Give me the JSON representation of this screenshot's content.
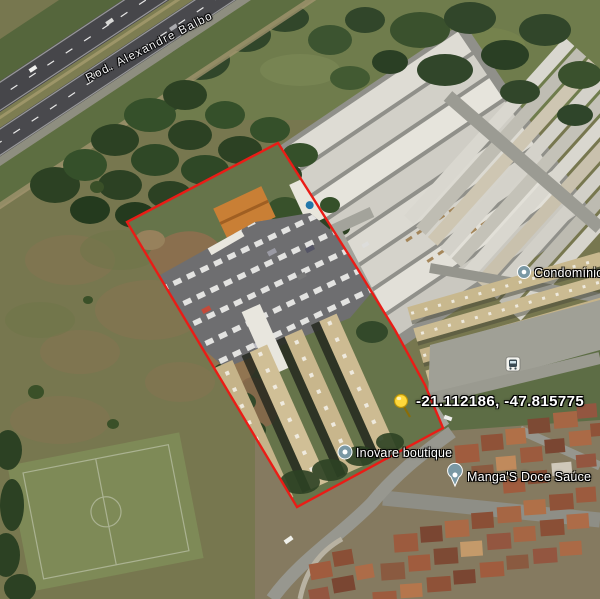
{
  "map": {
    "view": "satellite",
    "highway_label": "Rod. Alexandre Balbo",
    "pin": {
      "coordinates": "-21.112186, -47.815775",
      "icon": "yellow-pushpin",
      "color": "#ffd83b"
    },
    "boundary": {
      "shape": "polygon",
      "color": "#ea1c16"
    },
    "pois": [
      {
        "name": "Inovare boutique",
        "icon": "poi-circle"
      },
      {
        "name": "Manga'S Doce Saúce",
        "icon": "poi-circle"
      },
      {
        "name": "Condomínio Vi",
        "icon": "poi-circle"
      }
    ],
    "transit": {
      "icon": "bus-stop"
    }
  }
}
